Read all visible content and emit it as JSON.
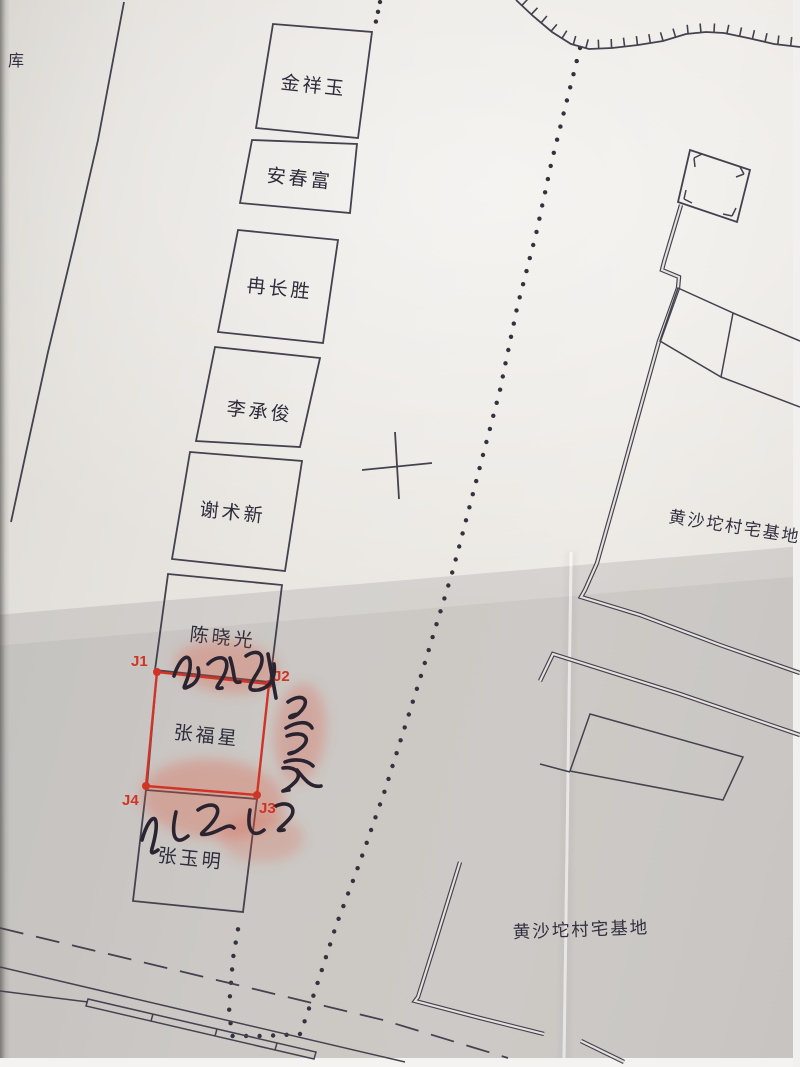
{
  "map": {
    "warehouse_label": "库",
    "plots": [
      {
        "name": "金祥玉"
      },
      {
        "name": "安春富"
      },
      {
        "name": "冉长胜"
      },
      {
        "name": "李承俊"
      },
      {
        "name": "谢术新"
      },
      {
        "name": "陈晓光"
      },
      {
        "name": "张福星",
        "highlighted": true
      },
      {
        "name": "张玉明"
      }
    ],
    "corner_markers": [
      {
        "label": "J1"
      },
      {
        "label": "J2"
      },
      {
        "label": "J3"
      },
      {
        "label": "J4"
      }
    ],
    "area_labels": [
      {
        "text": "黄沙坨村宅基地"
      },
      {
        "text": "黄沙坨村宅基地"
      }
    ],
    "signatures": [
      {
        "text": "陈晓光"
      },
      {
        "text": "安春致"
      },
      {
        "text": "张玉明"
      }
    ],
    "colors": {
      "parcel_outline": "#d13426",
      "marker_label": "#d13426",
      "ink": "#45414f",
      "paper": "#e9e6e1",
      "fingerprint": "#e0543c",
      "signature_ink": "#2a2430"
    }
  }
}
